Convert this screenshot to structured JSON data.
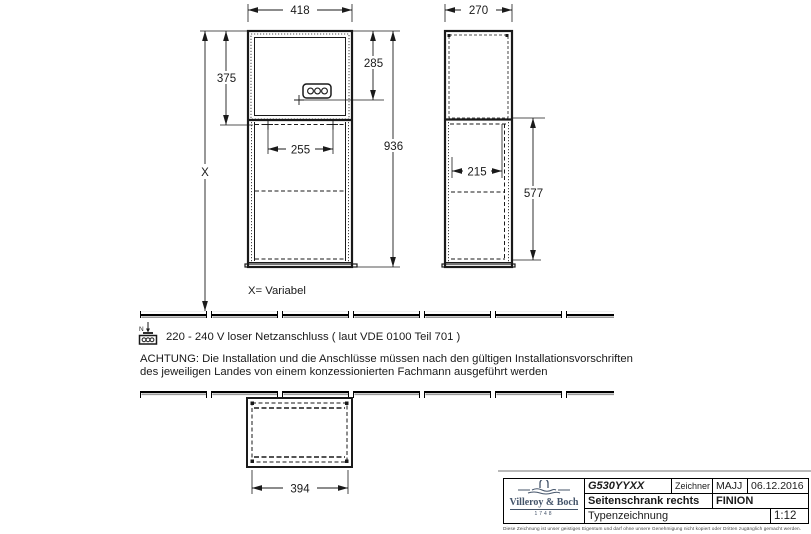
{
  "drawing": {
    "front_view": {
      "width_top": "418",
      "upper_height": "375",
      "socket_height": "285",
      "drill_spacing": "255",
      "total_height": "936",
      "variable_label": "X",
      "variable_note": "X= Variabel"
    },
    "side_view": {
      "depth": "270",
      "inner_depth": "215",
      "lower_height": "577"
    },
    "plan_view": {
      "width": "394"
    },
    "notes": {
      "symbol_letter": "N",
      "power": "220 - 240 V loser Netzanschluss ( laut VDE 0100 Teil 701 )",
      "warning_line1": "ACHTUNG: Die Installation und die Anschlüsse müssen nach den gültigen Installationsvorschriften",
      "warning_line2": "des jeweiligen Landes von einem konzessionierten Fachmann ausgeführt werden"
    }
  },
  "title_block": {
    "logo": {
      "brand": "Villeroy & Boch",
      "year": "1748"
    },
    "article_number": "G530YYXX",
    "drawer_label": "Zeichner",
    "drawer": "MAJJ",
    "date": "06.12.2016",
    "description": "Seitenschrank rechts",
    "series": "FINION",
    "drawing_type": "Typenzeichnung",
    "scale": "1:12",
    "disclaimer": "Diese Zeichnung ist unser geistiges Eigentum und darf ohne unsere Genehmigung nicht kopiert oder Dritten zugänglich gemacht werden."
  },
  "colors": {
    "line": "#1a1a1a",
    "logo_blue": "#44546a",
    "wall_shadow": "#9a9a9a"
  }
}
